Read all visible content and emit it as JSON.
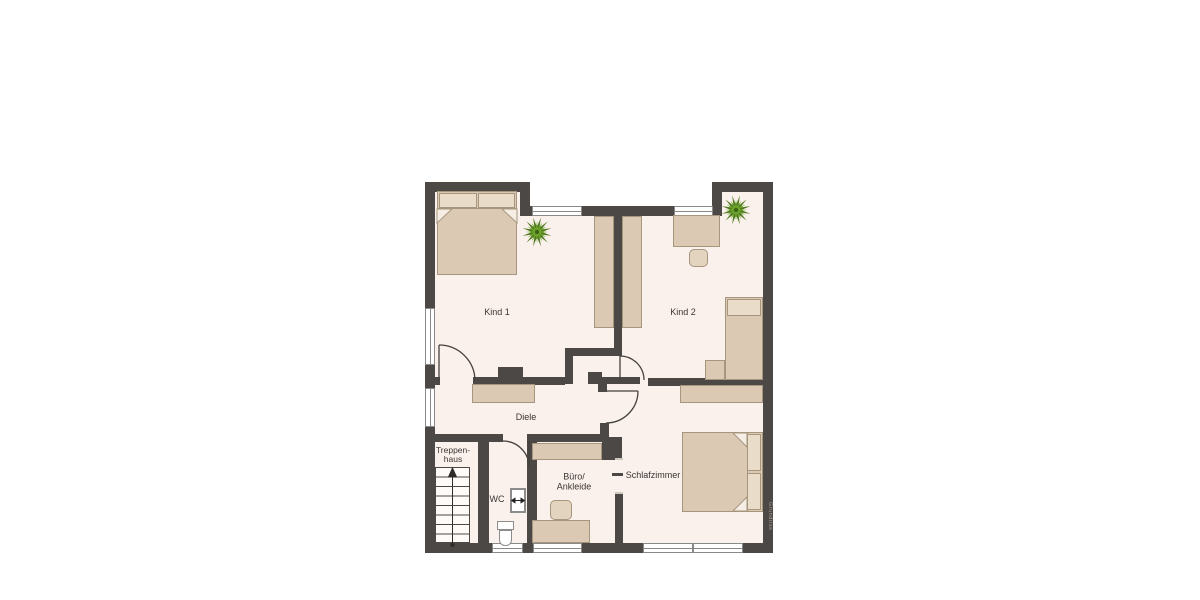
{
  "floorplan": {
    "rooms": {
      "kind1": {
        "label": "Kind 1"
      },
      "kind2": {
        "label": "Kind 2"
      },
      "diele": {
        "label": "Diele"
      },
      "treppenhaus": {
        "label_line1": "Treppen-",
        "label_line2": "haus"
      },
      "wc": {
        "label": "WC"
      },
      "buero": {
        "label_line1": "Büro/",
        "label_line2": "Ankleide"
      },
      "schlafzimmer": {
        "label": "Schlafzimmer"
      }
    },
    "watermark": "Grundriss",
    "colors": {
      "wall": "#4b4846",
      "floor": "#faf0ec",
      "furniture": "#dbc9b3",
      "furniture_border": "#a6967d",
      "pillow": "#e9dcc9",
      "plant_dark": "#4c7a1d",
      "plant_light": "#6fa42c",
      "window_frame": "#898989",
      "background": "#ffffff"
    }
  }
}
